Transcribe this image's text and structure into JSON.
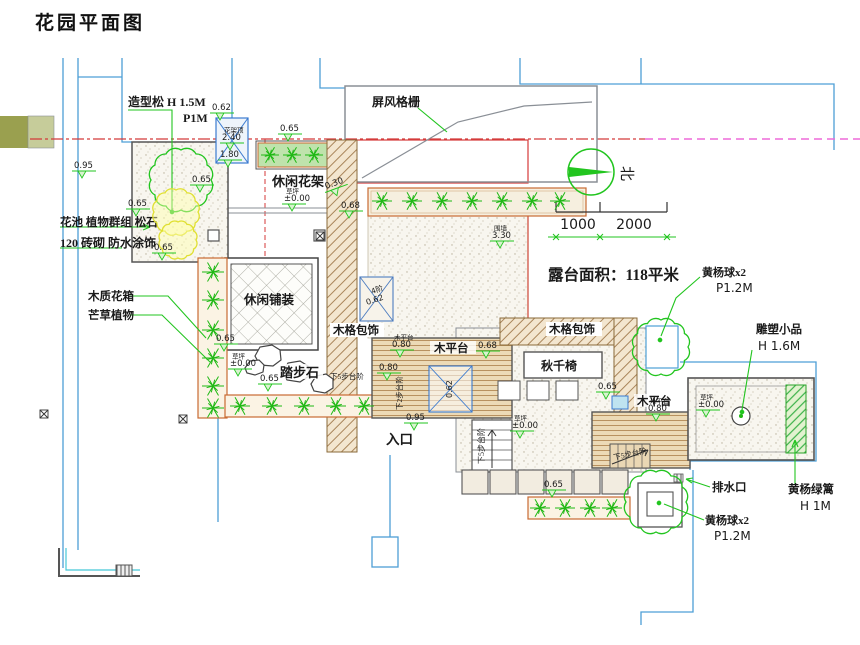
{
  "title": "花园平面图",
  "colors": {
    "boundary_blue": "#4d9fd6",
    "wall_gray": "#5a6066",
    "accent_red": "#d43a3a",
    "accent_magenta": "#ee6ad8",
    "plant_green": "#1fb814",
    "wood_tan": "#c79e6a",
    "planter_orange": "#c96a32",
    "shrub_yellow": "#e0e032",
    "cyan": "#45c8d8",
    "olive_dark": "#9aa04f",
    "olive_light": "#c6cc9a"
  },
  "annotations": {
    "pine_label_1": "造型松 H 1.5M",
    "pine_label_2": "P1M",
    "screen_label": "屏风格栅",
    "pergola_label": "休闲花架",
    "flowerbed_label_1": "花池 植物群组 松石",
    "flowerbed_label_2": "120 砖砌 防水涂饰",
    "wood_planter_label": "木质花箱",
    "grass_label": "芒草植物",
    "paving_label": "休闲铺装",
    "wood_trim_left_label": "木格包饰",
    "wood_trim_right_label": "木格包饰",
    "stepping_stone_label": "踏步石",
    "entrance_label": "入口",
    "deck_left_label": "木平台",
    "deck_right_label": "木平台",
    "swing_label": "秋千椅",
    "terrace_area_label": "露台面积：118平米",
    "boxwood_top_1": "黄杨球x2",
    "boxwood_top_2": "P1.2M",
    "sculpture_1": "雕塑小品",
    "sculpture_2": "H 1.6M",
    "drain_label": "排水口",
    "hedge_1": "黄杨绿篱",
    "hedge_2": "H 1M",
    "boxwood_bottom_1": "黄杨球x2",
    "boxwood_bottom_2": "P1.2M",
    "stairs5_left": "下5步台阶",
    "stairs5_mid": "下5步台阶",
    "stairs5_right": "下5步台阶",
    "stairs2": "下2步台阶",
    "stair4_line1": "4阶",
    "stair4_line2": "0.62",
    "table_height": "0.62",
    "north_label": "北"
  },
  "scale_bar": {
    "seg1": "1000",
    "seg2": "2000"
  },
  "elevations": [
    {
      "x": 74,
      "y": 168,
      "v": "0.95"
    },
    {
      "x": 192,
      "y": 182,
      "v": "0.65"
    },
    {
      "x": 128,
      "y": 206,
      "v": "0.65"
    },
    {
      "x": 154,
      "y": 250,
      "v": "0.65"
    },
    {
      "x": 222,
      "y": 140,
      "v": "2.40",
      "pre": "花架顶"
    },
    {
      "x": 220,
      "y": 157,
      "v": "1.80"
    },
    {
      "x": 280,
      "y": 131,
      "v": "0.65"
    },
    {
      "x": 212,
      "y": 110,
      "v": "0.62"
    },
    {
      "x": 326,
      "y": 189,
      "v": "0.30",
      "rot": -20
    },
    {
      "x": 341,
      "y": 208,
      "v": "0.68"
    },
    {
      "x": 492,
      "y": 238,
      "v": "3.30",
      "pre": "围墙"
    },
    {
      "x": 216,
      "y": 341,
      "v": "0.65"
    },
    {
      "x": 284,
      "y": 201,
      "v": "±0.00",
      "pre": "草坪"
    },
    {
      "x": 230,
      "y": 366,
      "v": "±0.00",
      "pre": "草坪"
    },
    {
      "x": 260,
      "y": 381,
      "v": "0.65"
    },
    {
      "x": 392,
      "y": 347,
      "v": "0.80",
      "pre": "木平台"
    },
    {
      "x": 379,
      "y": 370,
      "v": "0.80"
    },
    {
      "x": 406,
      "y": 420,
      "v": "0.95"
    },
    {
      "x": 512,
      "y": 428,
      "v": "±0.00",
      "pre": "草坪"
    },
    {
      "x": 698,
      "y": 407,
      "v": "±0.00",
      "pre": "草坪"
    },
    {
      "x": 648,
      "y": 411,
      "v": "0.80",
      "pre": "木平台"
    },
    {
      "x": 598,
      "y": 389,
      "v": "0.65"
    },
    {
      "x": 544,
      "y": 487,
      "v": "0.65"
    },
    {
      "x": 478,
      "y": 348,
      "v": "0.68"
    }
  ]
}
